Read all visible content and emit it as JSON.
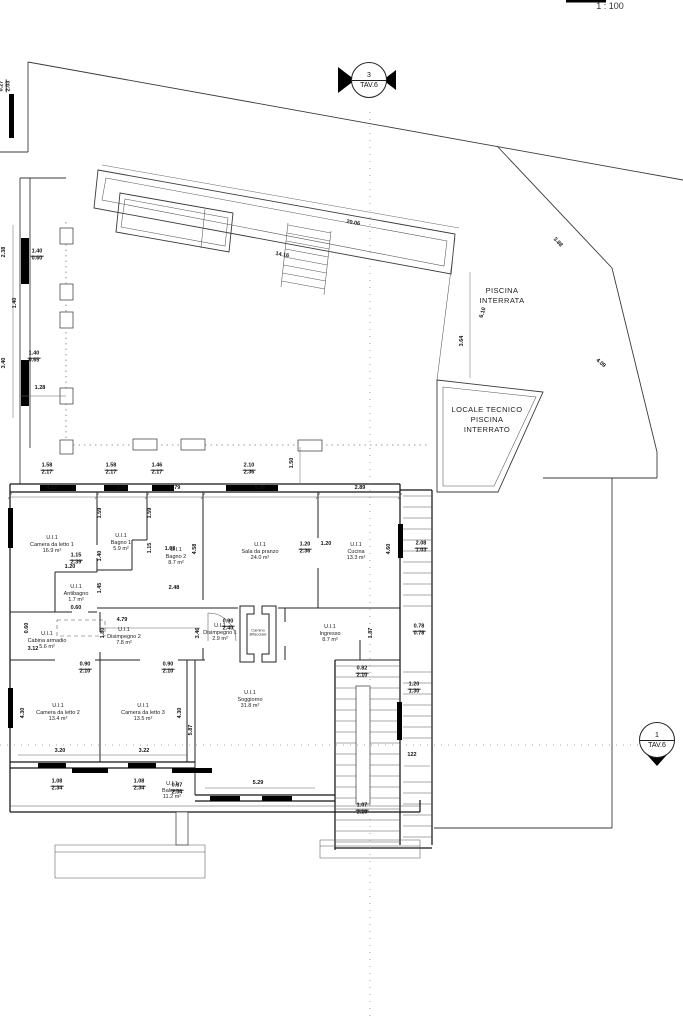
{
  "colors": {
    "background": "#ffffff",
    "line": "#3a3a3a",
    "wall": "#141414"
  },
  "scale": {
    "label": "1 : 100"
  },
  "markers": {
    "top": {
      "number": "3",
      "sheet": "TAV.6"
    },
    "right": {
      "number": "1",
      "sheet": "TAV.6"
    }
  },
  "site_labels": {
    "pool": "PISCINA\nINTERRATA",
    "technical_room": "LOCALE TECNICO\nPISCINA\nINTERRATO"
  },
  "fireplace_label": "Camino\nBifacciale",
  "unit_code": "U.I.1",
  "rooms": [
    {
      "id": "camera-da-letto-1",
      "name": "Camera da letto 1",
      "area": "16.9 m²",
      "x": 52,
      "y": 545
    },
    {
      "id": "bagno-1",
      "name": "Bagno 1",
      "area": "5.9 m²",
      "x": 121,
      "y": 543
    },
    {
      "id": "bagno-2",
      "name": "Bagno 2",
      "area": "8.7 m²",
      "x": 176,
      "y": 557
    },
    {
      "id": "antibagno",
      "name": "Antibagno",
      "area": "1.7 m²",
      "x": 76,
      "y": 594
    },
    {
      "id": "sala-da-pranzo",
      "name": "Sala da pranzo",
      "area": "24.0 m²",
      "x": 260,
      "y": 552
    },
    {
      "id": "cucina",
      "name": "Cucina",
      "area": "13.3 m²",
      "x": 356,
      "y": 552
    },
    {
      "id": "cabina-armadio",
      "name": "Cabina armadio",
      "area": "5.6 m²",
      "x": 47,
      "y": 641
    },
    {
      "id": "disimpegno-2",
      "name": "Disimpegno 2",
      "area": "7.8 m²",
      "x": 124,
      "y": 637
    },
    {
      "id": "disimpegno-1",
      "name": "Disimpegno 1",
      "area": "2.9 m²",
      "x": 220,
      "y": 633
    },
    {
      "id": "ingresso",
      "name": "Ingresso",
      "area": "8.7 m²",
      "x": 330,
      "y": 634
    },
    {
      "id": "camera-da-letto-2",
      "name": "Camera da letto 2",
      "area": "13.4 m²",
      "x": 58,
      "y": 713
    },
    {
      "id": "camera-da-letto-3",
      "name": "Camera da letto 3",
      "area": "13.5 m²",
      "x": 143,
      "y": 713
    },
    {
      "id": "soggiorno",
      "name": "Soggiorno",
      "area": "31.8 m²",
      "x": 250,
      "y": 700
    },
    {
      "id": "balcone",
      "name": "Balcone",
      "area": "11.2 m²",
      "x": 172,
      "y": 791
    }
  ],
  "dimensions": [
    {
      "t": "4.12",
      "x": 52,
      "y": 489
    },
    {
      "t": "1.85",
      "x": 122,
      "y": 489
    },
    {
      "t": "1.79",
      "x": 175,
      "y": 489
    },
    {
      "t": "5.25",
      "x": 260,
      "y": 489
    },
    {
      "t": "2.89",
      "x": 360,
      "y": 489
    },
    {
      "t": "1.59",
      "x": 101,
      "y": 513,
      "r": -90
    },
    {
      "t": "1.59",
      "x": 151,
      "y": 513,
      "r": -90
    },
    {
      "t": "1.40",
      "x": 101,
      "y": 556,
      "r": -90
    },
    {
      "t": "1.45",
      "x": 101,
      "y": 588,
      "r": -90
    },
    {
      "t": "1.15",
      "x": 151,
      "y": 548,
      "r": -90
    },
    {
      "t": "1.08",
      "x": 170,
      "y": 550
    },
    {
      "t": "1.20",
      "x": 70,
      "y": 568
    },
    {
      "t": "1.15/2.39",
      "x": 76,
      "y": 560
    },
    {
      "t": "2.48",
      "x": 174,
      "y": 589
    },
    {
      "t": "4.58",
      "x": 196,
      "y": 549,
      "r": -90
    },
    {
      "t": "1.20/2.36",
      "x": 305,
      "y": 549
    },
    {
      "t": "4.60",
      "x": 390,
      "y": 549,
      "r": -90
    },
    {
      "t": "1.20",
      "x": 326,
      "y": 545
    },
    {
      "t": "2.08/1.03",
      "x": 421,
      "y": 548
    },
    {
      "t": "0.60",
      "x": 76,
      "y": 609
    },
    {
      "t": "0.60",
      "x": 28,
      "y": 628,
      "r": -90
    },
    {
      "t": "3.12",
      "x": 33,
      "y": 650
    },
    {
      "t": "1.80",
      "x": 104,
      "y": 633,
      "r": -90
    },
    {
      "t": "4.79",
      "x": 122,
      "y": 621
    },
    {
      "t": "0.90/2.40",
      "x": 228,
      "y": 626
    },
    {
      "t": "3.46",
      "x": 199,
      "y": 633,
      "r": -90
    },
    {
      "t": "1.87",
      "x": 372,
      "y": 633,
      "r": -90
    },
    {
      "t": "0.78/0.78",
      "x": 419,
      "y": 631
    },
    {
      "t": "4.30",
      "x": 24,
      "y": 713,
      "r": -90
    },
    {
      "t": "4.30",
      "x": 181,
      "y": 713,
      "r": -90
    },
    {
      "t": "3.20",
      "x": 60,
      "y": 752
    },
    {
      "t": "3.22",
      "x": 144,
      "y": 752
    },
    {
      "t": "0.90/2.10",
      "x": 85,
      "y": 669
    },
    {
      "t": "0.90/2.10",
      "x": 168,
      "y": 669
    },
    {
      "t": "5.87",
      "x": 192,
      "y": 730,
      "r": -90
    },
    {
      "t": "5.29",
      "x": 258,
      "y": 784
    },
    {
      "t": "0.82/2.10",
      "x": 362,
      "y": 673
    },
    {
      "t": "1.07/2.10",
      "x": 362,
      "y": 810
    },
    {
      "t": "1.20/1.30",
      "x": 414,
      "y": 689
    },
    {
      "t": "122",
      "x": 412,
      "y": 756
    },
    {
      "t": "1.08/2.34",
      "x": 57,
      "y": 786
    },
    {
      "t": "1.08/2.34",
      "x": 139,
      "y": 786
    },
    {
      "t": "0.87/2.34",
      "x": 177,
      "y": 790
    },
    {
      "t": "2.38",
      "x": 5,
      "y": 252,
      "r": -90
    },
    {
      "t": "1.40",
      "x": 16,
      "y": 303,
      "r": -90
    },
    {
      "t": "3.40",
      "x": 5,
      "y": 363,
      "r": -90
    },
    {
      "t": "1.40/0.60",
      "x": 37,
      "y": 256
    },
    {
      "t": "1.40/0.65",
      "x": 34,
      "y": 358
    },
    {
      "t": "1.28",
      "x": 40,
      "y": 389
    },
    {
      "t": "0.27/2.03",
      "x": 6,
      "y": 86,
      "r": -90
    },
    {
      "t": "1.58/2.17",
      "x": 47,
      "y": 470
    },
    {
      "t": "1.58/2.17",
      "x": 111,
      "y": 470
    },
    {
      "t": "1.46/2.17",
      "x": 157,
      "y": 470
    },
    {
      "t": "2.10/2.36",
      "x": 249,
      "y": 470
    },
    {
      "t": "1.50",
      "x": 293,
      "y": 463,
      "r": -90
    },
    {
      "t": "20.06",
      "x": 353,
      "y": 224,
      "r": 10
    },
    {
      "t": "14.16",
      "x": 282,
      "y": 256,
      "r": 10
    },
    {
      "t": "6.10",
      "x": 484,
      "y": 313,
      "r": -73
    },
    {
      "t": "3.64",
      "x": 463,
      "y": 341,
      "r": -90
    },
    {
      "t": "3.88",
      "x": 557,
      "y": 243,
      "r": 47
    },
    {
      "t": "4.09",
      "x": 600,
      "y": 364,
      "r": 40
    }
  ]
}
